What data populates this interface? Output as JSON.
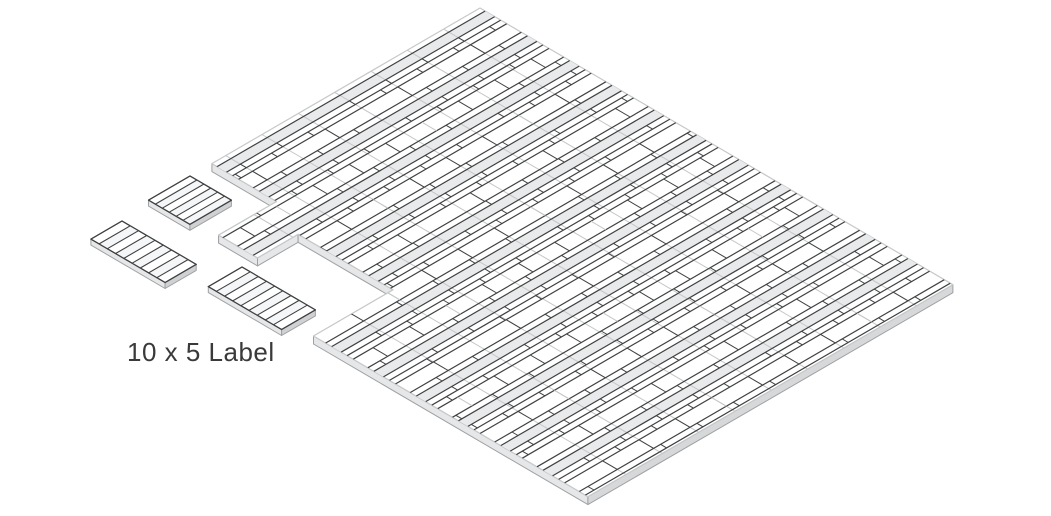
{
  "caption": {
    "text": "10 x 5 Label"
  },
  "colors": {
    "background": "#ffffff",
    "line_dark": "#3f4142",
    "line_light": "#c4c6c8",
    "band_fill": "#e8eaeb",
    "face_white": "#ffffff",
    "strip_alt_fill": "#f5f6f7",
    "side_light": "#e6e7e8",
    "side_mid": "#d6d8d9",
    "side_dark": "#cfd1d3",
    "side_edge": "#9fa1a3",
    "top_edge": "#c6c8ca",
    "caption_color": "#3a3a3a"
  },
  "diagram": {
    "iso": {
      "apex": [
        480,
        8
      ],
      "u": [
        -0.865,
        0.502
      ],
      "v": [
        0.863,
        0.505
      ]
    },
    "sheet": {
      "outline": [
        [
          0,
          0
        ],
        [
          310,
          0
        ],
        [
          310,
          75
        ],
        [
          377,
          75
        ],
        [
          377,
          120
        ],
        [
          330,
          120
        ],
        [
          330,
          230
        ],
        [
          422,
          230
        ],
        [
          422,
          548
        ],
        [
          0,
          548
        ]
      ],
      "extent_a": 422,
      "extent_b": 548,
      "thickness": 8,
      "rows": {
        "margin": 6,
        "repeat": 49,
        "count": 11,
        "band_h": 11,
        "thin_h": 7,
        "tall_h": 17
      },
      "columns": {
        "count": 10,
        "spacing": 42
      }
    },
    "pieces": [
      {
        "origin": [
          190,
          176
        ],
        "ua": 48,
        "vb": 48,
        "strips": 6,
        "thickness": 6
      },
      {
        "origin": [
          122,
          221
        ],
        "ua": 36,
        "vb": 86,
        "strips": 9,
        "thickness": 6
      },
      {
        "origin": [
          242,
          267
        ],
        "ua": 39,
        "vb": 85,
        "strips": 9,
        "thickness": 6
      }
    ]
  }
}
